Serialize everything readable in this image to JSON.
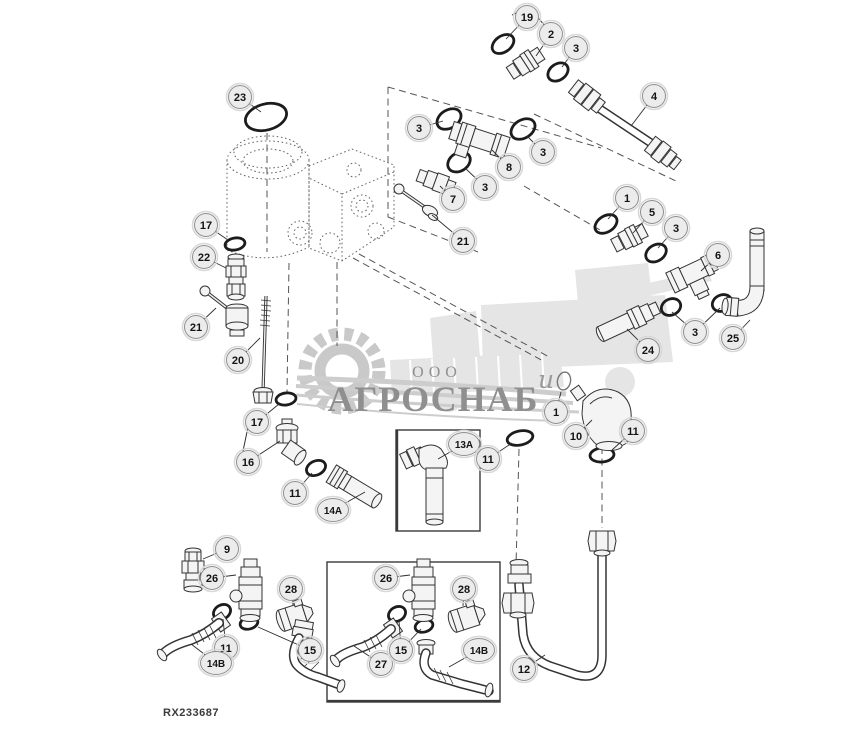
{
  "figure": {
    "code": "RX233687",
    "watermark": {
      "ooo": "ООО",
      "brand": "АГРОСНАБ",
      "script": "и"
    },
    "callouts": [
      {
        "label": "23",
        "x": 240,
        "y": 97,
        "leaders": [
          [
            261,
            112
          ]
        ]
      },
      {
        "label": "19",
        "x": 527,
        "y": 17,
        "leaders": [
          [
            506,
            39
          ]
        ]
      },
      {
        "label": "2",
        "x": 551,
        "y": 34,
        "leaders": [
          [
            536,
            56
          ]
        ]
      },
      {
        "label": "3",
        "x": 576,
        "y": 48,
        "leaders": [
          [
            562,
            67
          ]
        ]
      },
      {
        "label": "4",
        "x": 654,
        "y": 96,
        "leaders": [
          [
            631,
            126
          ]
        ]
      },
      {
        "label": "3",
        "x": 419,
        "y": 128,
        "leaders": [
          [
            443,
            121
          ]
        ]
      },
      {
        "label": "3",
        "x": 543,
        "y": 152,
        "leaders": [
          [
            527,
            136
          ]
        ]
      },
      {
        "label": "8",
        "x": 509,
        "y": 167,
        "leaders": [
          [
            492,
            150
          ]
        ]
      },
      {
        "label": "3",
        "x": 485,
        "y": 187,
        "leaders": [
          [
            465,
            168
          ]
        ]
      },
      {
        "label": "7",
        "x": 453,
        "y": 199,
        "leaders": [
          [
            440,
            186
          ]
        ]
      },
      {
        "label": "21",
        "x": 463,
        "y": 241,
        "leaders": [
          [
            432,
            215
          ]
        ]
      },
      {
        "label": "17",
        "x": 206,
        "y": 225,
        "leaders": [
          [
            228,
            240
          ]
        ]
      },
      {
        "label": "22",
        "x": 204,
        "y": 257,
        "leaders": [
          [
            226,
            268
          ]
        ]
      },
      {
        "label": "21",
        "x": 196,
        "y": 327,
        "leaders": [
          [
            216,
            308
          ]
        ]
      },
      {
        "label": "20",
        "x": 238,
        "y": 360,
        "leaders": [
          [
            260,
            338
          ]
        ]
      },
      {
        "label": "1",
        "x": 627,
        "y": 198,
        "leaders": [
          [
            608,
            219
          ]
        ]
      },
      {
        "label": "5",
        "x": 652,
        "y": 212,
        "leaders": [
          [
            633,
            233
          ]
        ]
      },
      {
        "label": "3",
        "x": 676,
        "y": 228,
        "leaders": [
          [
            658,
            248
          ]
        ]
      },
      {
        "label": "6",
        "x": 718,
        "y": 255,
        "leaders": [
          [
            701,
            271
          ]
        ]
      },
      {
        "label": "3",
        "x": 695,
        "y": 332,
        "leaders": [
          [
            672,
            312
          ],
          [
            720,
            308
          ]
        ]
      },
      {
        "label": "24",
        "x": 648,
        "y": 350,
        "leaders": [
          [
            627,
            329
          ]
        ]
      },
      {
        "label": "25",
        "x": 733,
        "y": 338,
        "leaders": [
          [
            750,
            320
          ]
        ]
      },
      {
        "label": "17",
        "x": 257,
        "y": 422,
        "leaders": [
          [
            279,
            404
          ]
        ]
      },
      {
        "label": "16",
        "x": 248,
        "y": 462,
        "leaders": [
          [
            280,
            441
          ]
        ]
      },
      {
        "label": "11",
        "x": 295,
        "y": 493,
        "leaders": [
          [
            312,
            473
          ]
        ]
      },
      {
        "label": "14A",
        "x": 333,
        "y": 510,
        "leaders": [
          [
            365,
            492
          ]
        ]
      },
      {
        "label": "13A",
        "x": 464,
        "y": 444,
        "leaders": [
          [
            438,
            459
          ]
        ]
      },
      {
        "label": "11",
        "x": 488,
        "y": 459,
        "leaders": [
          [
            512,
            443
          ]
        ]
      },
      {
        "label": "1",
        "x": 556,
        "y": 412,
        "leaders": [
          [
            561,
            392
          ]
        ]
      },
      {
        "label": "10",
        "x": 576,
        "y": 436,
        "leaders": [
          [
            592,
            420
          ]
        ]
      },
      {
        "label": "11",
        "x": 633,
        "y": 431,
        "leaders": [
          [
            612,
            450
          ]
        ]
      },
      {
        "label": "9",
        "x": 227,
        "y": 549,
        "leaders": [
          [
            203,
            559
          ]
        ]
      },
      {
        "label": "26",
        "x": 212,
        "y": 578,
        "leaders": [
          [
            236,
            575
          ]
        ]
      },
      {
        "label": "28",
        "x": 291,
        "y": 589,
        "leaders": [
          [
            293,
            605
          ]
        ]
      },
      {
        "label": "11",
        "x": 226,
        "y": 648,
        "leaders": [
          [
            223,
            619
          ]
        ]
      },
      {
        "label": "14B",
        "x": 216,
        "y": 663,
        "leaders": [
          [
            191,
            644
          ]
        ]
      },
      {
        "label": "15",
        "x": 310,
        "y": 650,
        "leaders": [
          [
            258,
            627
          ]
        ]
      },
      {
        "label": "26",
        "x": 386,
        "y": 578,
        "leaders": [
          [
            410,
            575
          ]
        ]
      },
      {
        "label": "28",
        "x": 464,
        "y": 589,
        "leaders": [
          [
            463,
            606
          ]
        ]
      },
      {
        "label": "27",
        "x": 381,
        "y": 664,
        "leaders": [
          [
            354,
            646
          ]
        ]
      },
      {
        "label": "15",
        "x": 401,
        "y": 650,
        "leaders": [
          [
            399,
            620
          ],
          [
            421,
            629
          ]
        ]
      },
      {
        "label": "14B",
        "x": 479,
        "y": 650,
        "leaders": [
          [
            449,
            667
          ]
        ]
      },
      {
        "label": "12",
        "x": 524,
        "y": 669,
        "leaders": [
          [
            545,
            655
          ]
        ]
      }
    ]
  }
}
